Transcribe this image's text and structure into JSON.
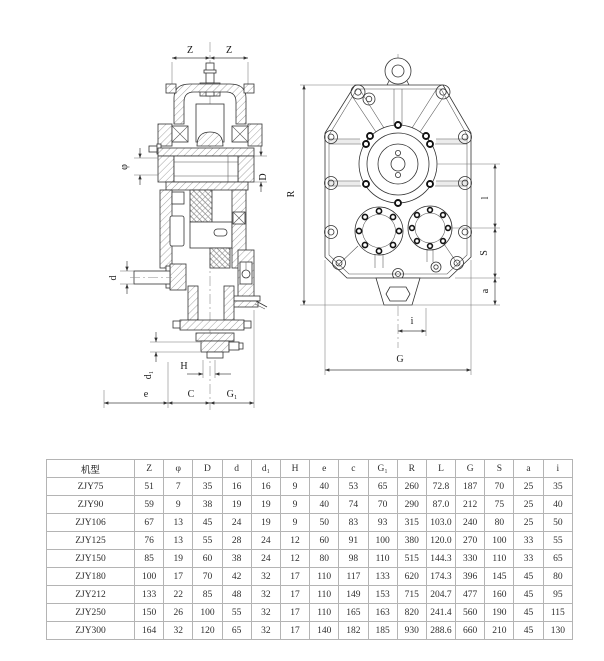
{
  "colors": {
    "line": "#333333",
    "background": "#ffffff",
    "table_border": "#b4b4b4",
    "table_frame": "#5f5f5f",
    "text": "#2e2e2e"
  },
  "drawing": {
    "left_view": {
      "name": "side-section-view",
      "labels": {
        "z_left": "Z",
        "z_right": "Z",
        "phi": "φ",
        "D": "D",
        "d": "d",
        "d1": "d₁",
        "H": "H",
        "e": "e",
        "C": "C",
        "G1": "G₁"
      }
    },
    "right_view": {
      "name": "front-view",
      "labels": {
        "R": "R",
        "l": "l",
        "S": "S",
        "a": "a",
        "i": "i",
        "G": "G"
      }
    }
  },
  "table": {
    "columns": [
      "机型",
      "Z",
      "φ",
      "D",
      "d",
      "d₁",
      "H",
      "e",
      "c",
      "G₁",
      "R",
      "L",
      "G",
      "S",
      "a",
      "i"
    ],
    "rows": [
      [
        "ZJY75",
        "51",
        "7",
        "35",
        "16",
        "16",
        "9",
        "40",
        "53",
        "65",
        "260",
        "72.8",
        "187",
        "70",
        "25",
        "35"
      ],
      [
        "ZJY90",
        "59",
        "9",
        "38",
        "19",
        "19",
        "9",
        "40",
        "74",
        "70",
        "290",
        "87.0",
        "212",
        "75",
        "25",
        "40"
      ],
      [
        "ZJY106",
        "67",
        "13",
        "45",
        "24",
        "19",
        "9",
        "50",
        "83",
        "93",
        "315",
        "103.0",
        "240",
        "80",
        "25",
        "50"
      ],
      [
        "ZJY125",
        "76",
        "13",
        "55",
        "28",
        "24",
        "12",
        "60",
        "91",
        "100",
        "380",
        "120.0",
        "270",
        "100",
        "33",
        "55"
      ],
      [
        "ZJY150",
        "85",
        "19",
        "60",
        "38",
        "24",
        "12",
        "80",
        "98",
        "110",
        "515",
        "144.3",
        "330",
        "110",
        "33",
        "65"
      ],
      [
        "ZJY180",
        "100",
        "17",
        "70",
        "42",
        "32",
        "17",
        "110",
        "117",
        "133",
        "620",
        "174.3",
        "396",
        "145",
        "45",
        "80"
      ],
      [
        "ZJY212",
        "133",
        "22",
        "85",
        "48",
        "32",
        "17",
        "110",
        "149",
        "153",
        "715",
        "204.7",
        "477",
        "160",
        "45",
        "95"
      ],
      [
        "ZJY250",
        "150",
        "26",
        "100",
        "55",
        "32",
        "17",
        "110",
        "165",
        "163",
        "820",
        "241.4",
        "560",
        "190",
        "45",
        "115"
      ],
      [
        "ZJY300",
        "164",
        "32",
        "120",
        "65",
        "32",
        "17",
        "140",
        "182",
        "185",
        "930",
        "288.6",
        "660",
        "210",
        "45",
        "130"
      ]
    ]
  }
}
